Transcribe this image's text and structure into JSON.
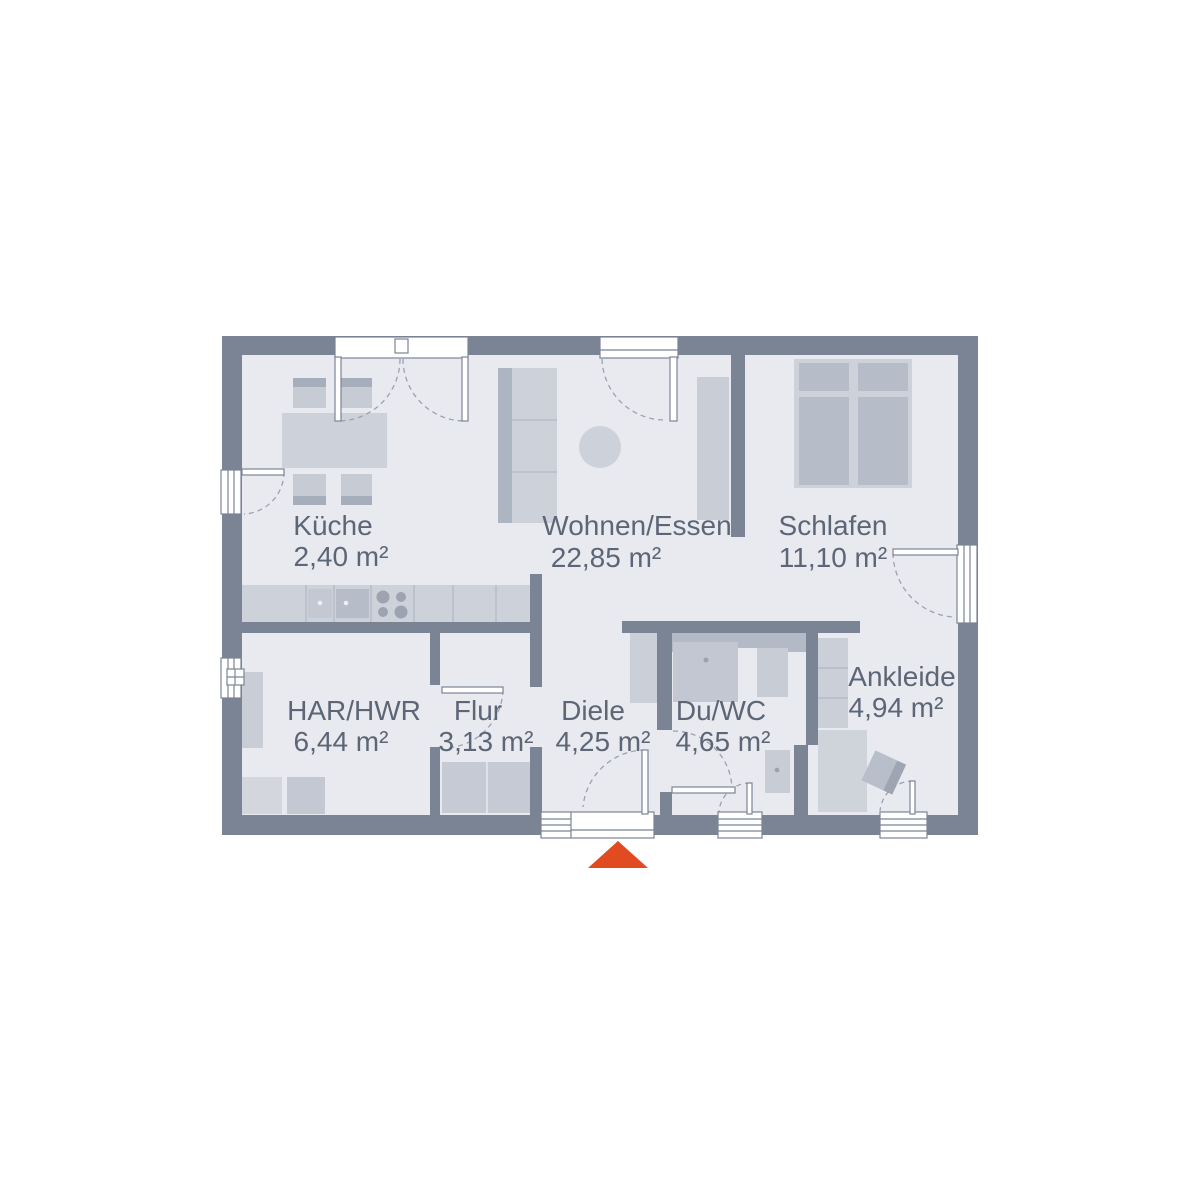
{
  "plan": {
    "title": "floor-plan",
    "rooms": [
      {
        "id": "kueche",
        "name": "Küche",
        "area": "2,40 m²"
      },
      {
        "id": "wohnen-essen",
        "name": "Wohnen/Essen",
        "area": "22,85 m²"
      },
      {
        "id": "schlafen",
        "name": "Schlafen",
        "area": "11,10 m²"
      },
      {
        "id": "har-hwr",
        "name": "HAR/HWR",
        "area": "6,44 m²"
      },
      {
        "id": "flur",
        "name": "Flur",
        "area": "3,13 m²"
      },
      {
        "id": "diele",
        "name": "Diele",
        "area": "4,25 m²"
      },
      {
        "id": "du-wc",
        "name": "Du/WC",
        "area": "4,65 m²"
      },
      {
        "id": "ankleide",
        "name": "Ankleide",
        "area": "4,94 m²"
      }
    ],
    "colors": {
      "wall": "#7b8495",
      "floor": "#e8eaef",
      "furniture_light": "#cdd1d9",
      "furniture_mid": "#b6bcc8",
      "label_text": "#5d6676",
      "entrance_accent": "#e14b21",
      "background": "#ffffff"
    },
    "markers": {
      "entrance_arrow": "south-entrance-arrow"
    }
  }
}
